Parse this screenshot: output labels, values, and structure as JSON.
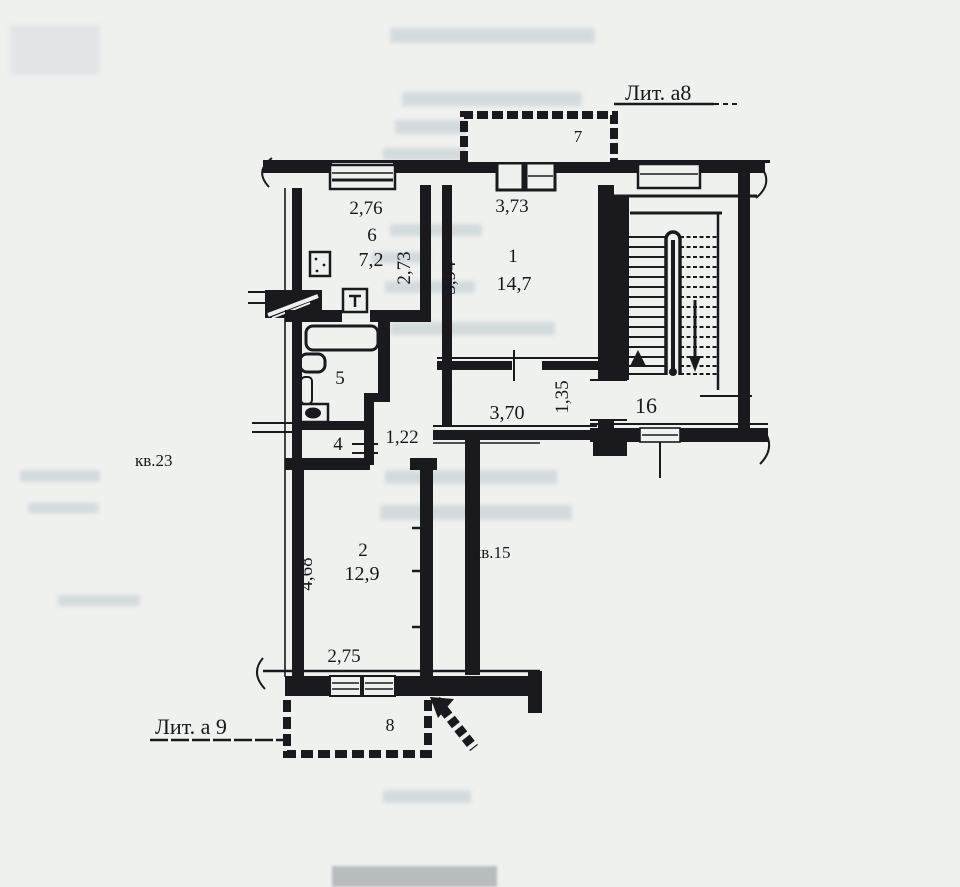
{
  "plan": {
    "annotations": {
      "lit_a8": "Лит. а8",
      "lit_a9": "Лит. а 9",
      "apt23": "кв.23",
      "apt15": "кв.15"
    },
    "rooms": {
      "room1": {
        "number": "1",
        "area": "14,7"
      },
      "room2": {
        "number": "2",
        "area": "12,9"
      },
      "room3": {
        "number": "3"
      },
      "room4": {
        "number": "4"
      },
      "room5": {
        "number": "5"
      },
      "room6": {
        "number": "6",
        "area": "7,2"
      },
      "balcony7": {
        "number": "7"
      },
      "balcony8": {
        "number": "8"
      },
      "stairwell": {
        "number": "16"
      }
    },
    "dimensions": {
      "d276": "2,76",
      "d273": "2,73",
      "d373": "3,73",
      "d394": "3,94",
      "d370": "3,70",
      "d135": "1,35",
      "d122": "1,22",
      "d468": "4,68",
      "d275": "2,75"
    },
    "colors": {
      "ink": "#1a1a1e",
      "paper": "#eff1ef"
    }
  }
}
